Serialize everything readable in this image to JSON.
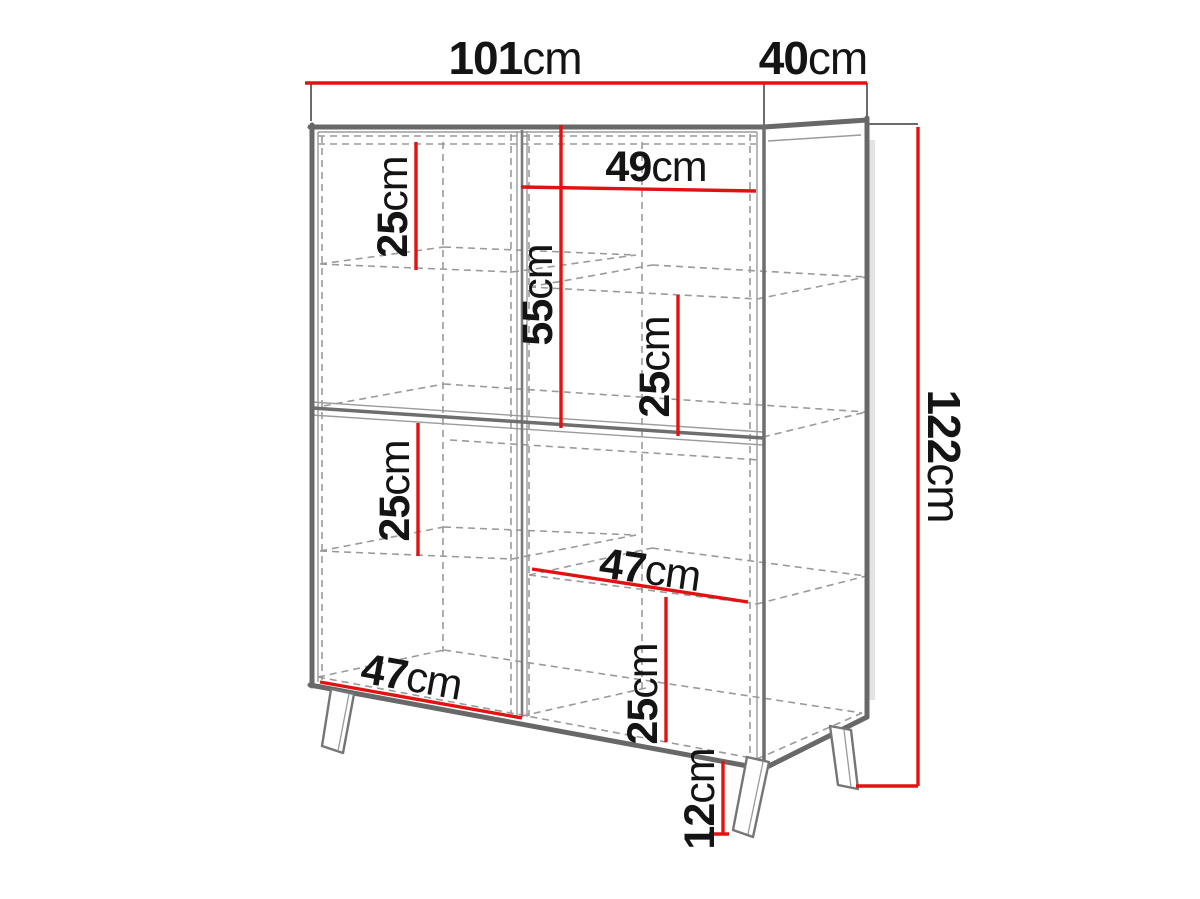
{
  "diagram": {
    "type": "furniture-dimension-diagram",
    "subject": "four-door display cabinet on splayed legs, drawn in perspective with dashed hidden edges",
    "background": "#ffffff",
    "accent_color": "#e31212",
    "outline_color": "#686868",
    "dashed_color": "#9a9a9a",
    "text_color": "#141414"
  },
  "dimensions": {
    "width": {
      "value": "101",
      "unit": "cm"
    },
    "depth": {
      "value": "40",
      "unit": "cm"
    },
    "height": {
      "value": "122",
      "unit": "cm"
    },
    "upper_left_shelf": {
      "value": "25",
      "unit": "cm"
    },
    "upper_right_compartment_width": {
      "value": "49",
      "unit": "cm"
    },
    "upper_section_height": {
      "value": "55",
      "unit": "cm"
    },
    "upper_right_shelf": {
      "value": "25",
      "unit": "cm"
    },
    "lower_left_shelf": {
      "value": "25",
      "unit": "cm"
    },
    "lower_right_compartment_width": {
      "value": "47",
      "unit": "cm"
    },
    "lower_left_compartment_width": {
      "value": "47",
      "unit": "cm"
    },
    "lower_right_shelf": {
      "value": "25",
      "unit": "cm"
    },
    "leg_height": {
      "value": "12",
      "unit": "cm"
    }
  }
}
